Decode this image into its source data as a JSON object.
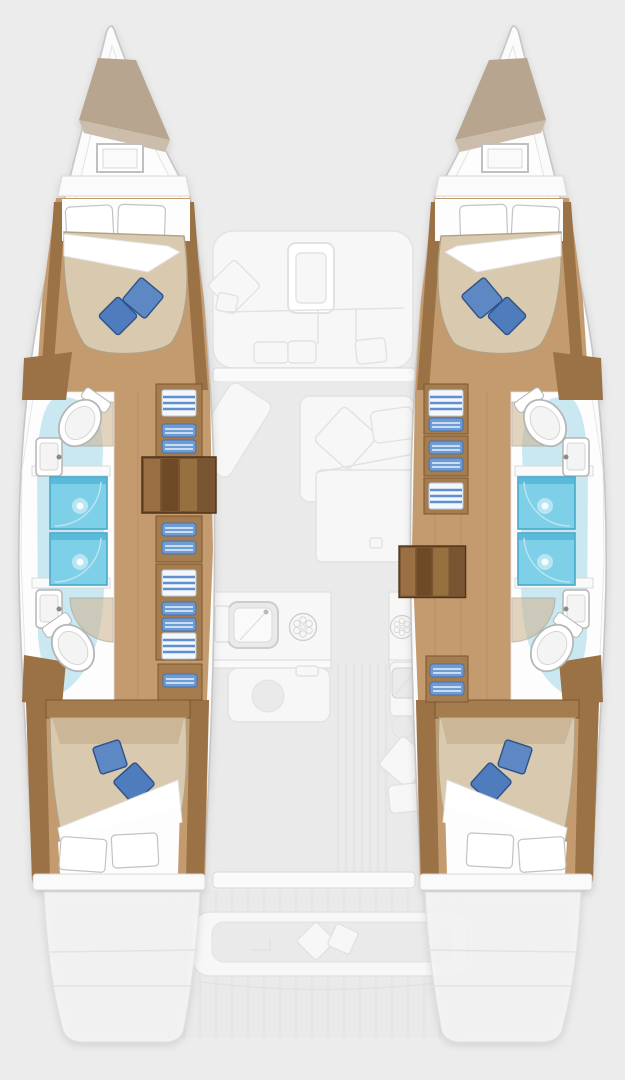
{
  "scene": {
    "type": "catamaran-deck-plan",
    "view": "top-down",
    "hulls": [
      {
        "id": "port-hull",
        "side": "left",
        "rooms": [
          "bow-locker",
          "forward-cabin",
          "forward-bathroom",
          "shower",
          "corridor-with-steps",
          "aft-cabin",
          "stern-platform"
        ]
      },
      {
        "id": "starboard-hull",
        "side": "right",
        "rooms": [
          "bow-locker",
          "forward-cabin",
          "forward-bathroom",
          "shower",
          "corridor-with-steps",
          "aft-cabin",
          "stern-platform"
        ]
      }
    ],
    "center_deck_faded": [
      "forward-cockpit-seat",
      "deck-hatch",
      "salon-lounge",
      "chaise",
      "galley-sink",
      "galley-burners",
      "chart-desk",
      "companionway",
      "aft-cockpit-bench",
      "cockpit-table"
    ]
  },
  "colors": {
    "background": "#ececec",
    "hull_shell": "#fbfbfb",
    "hull_outline": "#c6c6c6",
    "interior_white": "#fdfdfd",
    "interior_line": "#e3e3e3",
    "wood_floor": "#c49b6f",
    "wood_plank": "#b3895c",
    "wood_dark": "#9b7146",
    "cabinet_wood": "#a57c4e",
    "cabinet_edge": "#7c5630",
    "steps_a": "#9a6f44",
    "steps_b": "#7a5533",
    "steps_c": "#96703f",
    "steps_d": "#6e4b26",
    "steps_edge": "#4f3318",
    "bow_locker": "#b7a58f",
    "bow_locker_fold": "#cbbda9",
    "bed_beige": "#d9c9af",
    "bed_edge": "#b0a084",
    "bed_head": "#cbb798",
    "pillow_blue": "#5d88c4",
    "pillow_blue_deep": "#4f7cbc",
    "pillow_edge": "#2f5288",
    "towel_blue": "#6d9bd3",
    "towel_edge": "#4a6fa8",
    "towel_stripe": "#eaf2fc",
    "linen_white": "#f4f7fb",
    "linen_edge": "#b9c9dd",
    "linen_stripe": "#5f8fcc",
    "shower_fill": "#7ecfe8",
    "shower_edge": "#49a8c8",
    "shower_top": "#54b6d6",
    "shower_arc": "#bfe4f0",
    "wet_floor": "#c9e8f2",
    "fixture_fill": "#ffffff",
    "fixture_edge": "#b5b5b5",
    "fixture_inner": "#f4f4f4",
    "fixture_inner_edge": "#d5d5d5",
    "faucet": "#8a8a8a",
    "partition": "#fafafa",
    "partition_edge": "#d8d8d8",
    "door_wood": "#cdb28d",
    "door_edge": "#9a8a74",
    "fade_fill": "#f7f7f7",
    "fade_edge": "#e2e2e2",
    "deck_floor": "#eaeaea",
    "stripe": "#e4e4e4"
  }
}
